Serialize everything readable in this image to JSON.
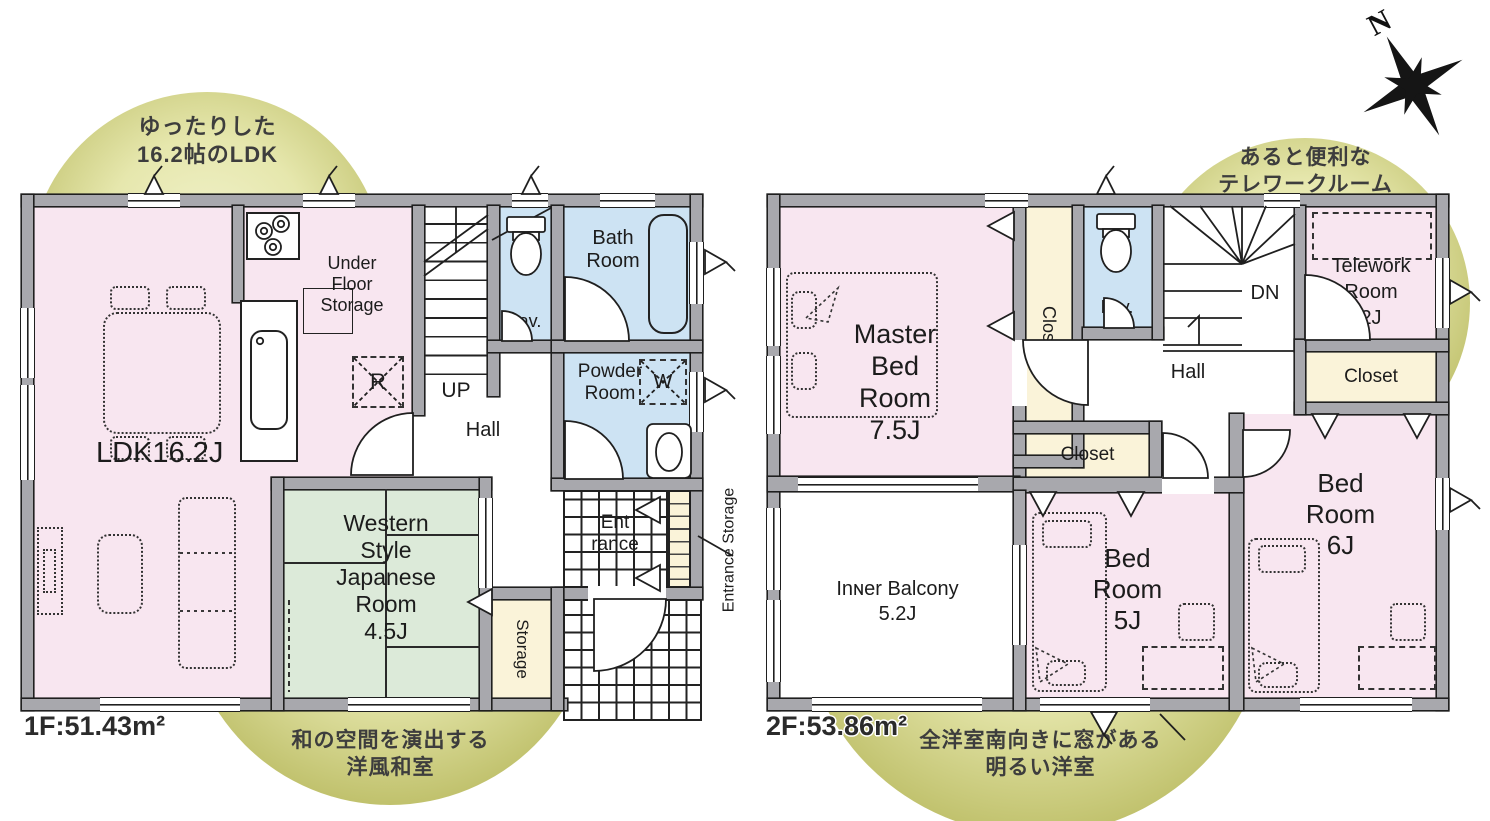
{
  "colors": {
    "room-pink": "#f8e6f0",
    "room-blue": "#cde3f3",
    "room-green": "#dcead9",
    "room-cream": "#faf3d9",
    "wall-gray": "#a8a8ad",
    "line-dark": "#1f1f1f",
    "callout-olive": "#c0c16c",
    "callout-olive-light": "#f1f2cc"
  },
  "compass": {
    "north": "N"
  },
  "floor1": {
    "area": "1F:51.43m²",
    "callout_top": [
      "ゆったりした",
      "16.2帖のLDK"
    ],
    "callout_bottom": [
      "和の空間を演出する",
      "洋風和室"
    ],
    "ldk": "LDK16.2J",
    "under_floor": [
      "Under",
      "Floor",
      "Storage"
    ],
    "fridge": "R",
    "up": "UP",
    "hall": "Hall",
    "lav": "Lav.",
    "bath": [
      "Bath",
      "Room"
    ],
    "powder": [
      "Powder",
      "Room"
    ],
    "washer": "W",
    "japanese": [
      "Western",
      "Style",
      "Japanese",
      "Room",
      "4.5J"
    ],
    "storage": "Storage",
    "entrance": [
      "Ent",
      "rance"
    ],
    "entrance_storage": "Entrance Storage"
  },
  "floor2": {
    "area": "2F:53.86m²",
    "callout_top": [
      "あると便利な",
      "テレワークルーム"
    ],
    "callout_bottom": [
      "全洋室南向きに窓がある",
      "明るい洋室"
    ],
    "master": [
      "Master",
      "Bed",
      "Room",
      "7.5J"
    ],
    "closet_master": "Closet",
    "lav": "Lav.",
    "down": "DN",
    "hall": "Hall",
    "telework": [
      "Telework",
      "Room",
      "2J"
    ],
    "closet_east": "Closet",
    "closet_center": "Closet",
    "balcony": [
      "Inɴer Balcony",
      "5.2J"
    ],
    "bed5": [
      "Bed",
      "Room",
      "5J"
    ],
    "bed6": [
      "Bed",
      "Room",
      "6J"
    ]
  }
}
